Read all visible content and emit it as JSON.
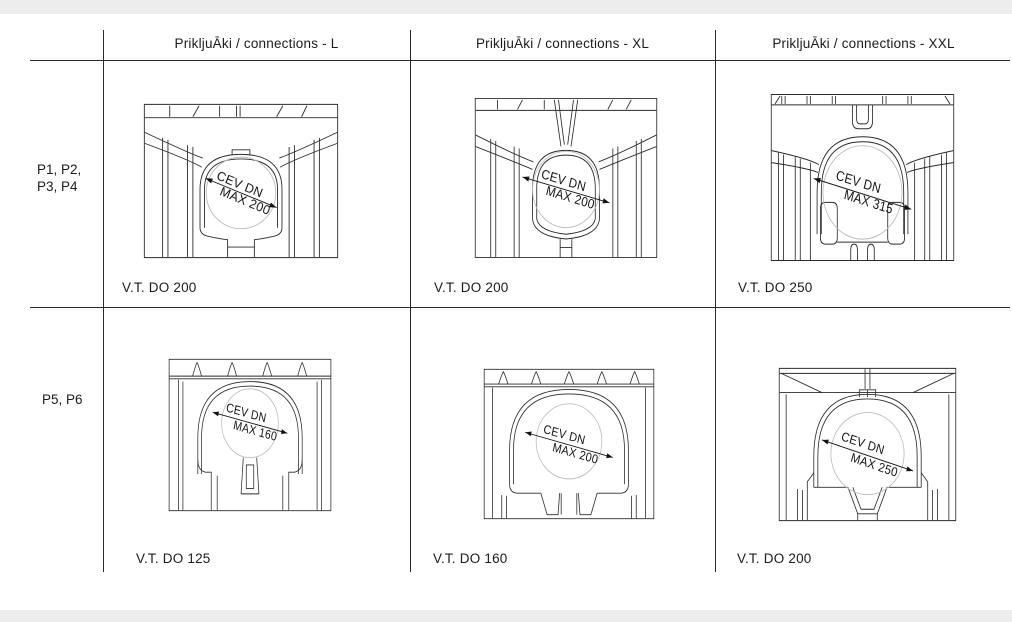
{
  "table": {
    "col_headers": [
      "PrikljuĀki / connections - L",
      "PrikljuĀki / connections - XL",
      "PrikljuĀki / connections - XXL"
    ],
    "rows": [
      {
        "label_line1": "P1, P2,",
        "label_line2": "P3, P4",
        "cells": [
          {
            "dim_line1": "CEV DN",
            "dim_line2": "MAX 200",
            "caption": "V.T. DO 200"
          },
          {
            "dim_line1": "CEV DN",
            "dim_line2": "MAX 200",
            "caption": "V.T. DO 200"
          },
          {
            "dim_line1": "CEV DN",
            "dim_line2": "MAX 315",
            "caption": "V.T. DO 250"
          }
        ]
      },
      {
        "label_line1": "P5, P6",
        "label_line2": "",
        "cells": [
          {
            "dim_line1": "CEV DN",
            "dim_line2": "MAX 160",
            "caption": "V.T. DO 125"
          },
          {
            "dim_line1": "CEV DN",
            "dim_line2": "MAX 200",
            "caption": "V.T. DO 160"
          },
          {
            "dim_line1": "CEV DN",
            "dim_line2": "MAX 250",
            "caption": "V.T. DO 200"
          }
        ]
      }
    ]
  }
}
